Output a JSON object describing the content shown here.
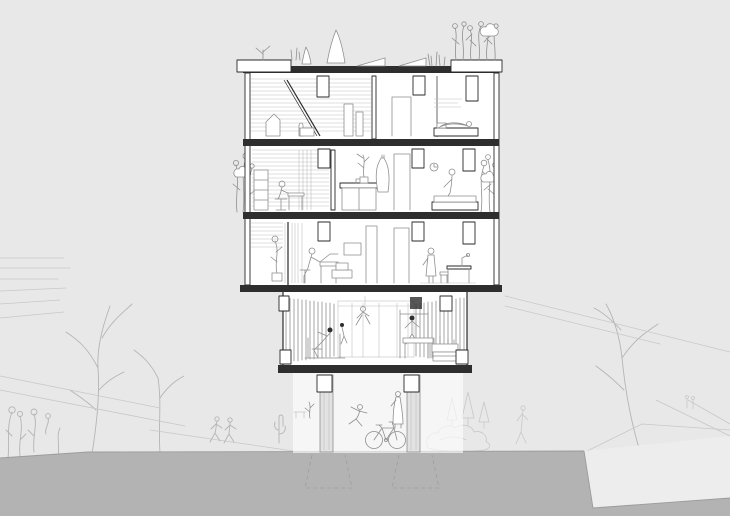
{
  "scene": {
    "label": "Architectural cross-section drawing of a five-level building with rooftop garden, three residential floors, an open workshop level on pilotis, and a sketched park landscape",
    "roof": {
      "items": [
        "planter-left",
        "roof-tree",
        "rooftop-figures",
        "solar-panels",
        "grass-tufts",
        "planter-right-flowers"
      ]
    },
    "floors": [
      {
        "name": "top-floor",
        "items": [
          "louvered-wall",
          "stair-rail",
          "partition",
          "door",
          "bed-with-person-lying",
          "wall-art"
        ]
      },
      {
        "name": "middle-floor",
        "items": [
          "balcony-plants-left",
          "person-at-desk",
          "shelf",
          "kitchen-counter",
          "potted-plant",
          "hanging-robe",
          "door",
          "wall-clock",
          "person-sitting-on-bed",
          "bed",
          "balcony-plants-right"
        ]
      },
      {
        "name": "lower-floor",
        "items": [
          "slatted-screen",
          "plant",
          "person-at-piano-desk",
          "picture-frame",
          "boxes",
          "doors",
          "standing-person",
          "desk-with-lamp"
        ]
      },
      {
        "name": "open-workshop-level",
        "items": [
          "glass-mullions",
          "back-wall-doors",
          "wall-cabinet",
          "climbing-figure",
          "rowing-person",
          "press-machine-person",
          "workbench"
        ]
      },
      {
        "name": "ground-pilotis",
        "items": [
          "columns",
          "beam-stubs",
          "footings",
          "bicycle",
          "dancing-figure",
          "standing-figure",
          "small-plant",
          "bench"
        ]
      }
    ],
    "landscape": [
      "trees-left",
      "trees-right",
      "terraced-fields",
      "paths",
      "walking-figures",
      "cactus",
      "rocks",
      "pine-trees",
      "flower-shrubs",
      "plaza-wedge",
      "ground-band"
    ]
  },
  "colors": {
    "background": "#e8e8e8",
    "plaza": "#ededed",
    "ground_band": "#b3b3b3",
    "band_edge": "#9c9c9c",
    "building_line": "#2a2a2a",
    "structure_fill": "#2e2e2e",
    "interior_line": "#8f8f8f",
    "louver_line": "#bfbfbf",
    "sketch_line": "#c8c8c8",
    "foreground_sketch_line": "#b5b5b5",
    "column_fill": "#e2e2e2",
    "footing_line": "#9e9e9e",
    "white": "#ffffff"
  }
}
